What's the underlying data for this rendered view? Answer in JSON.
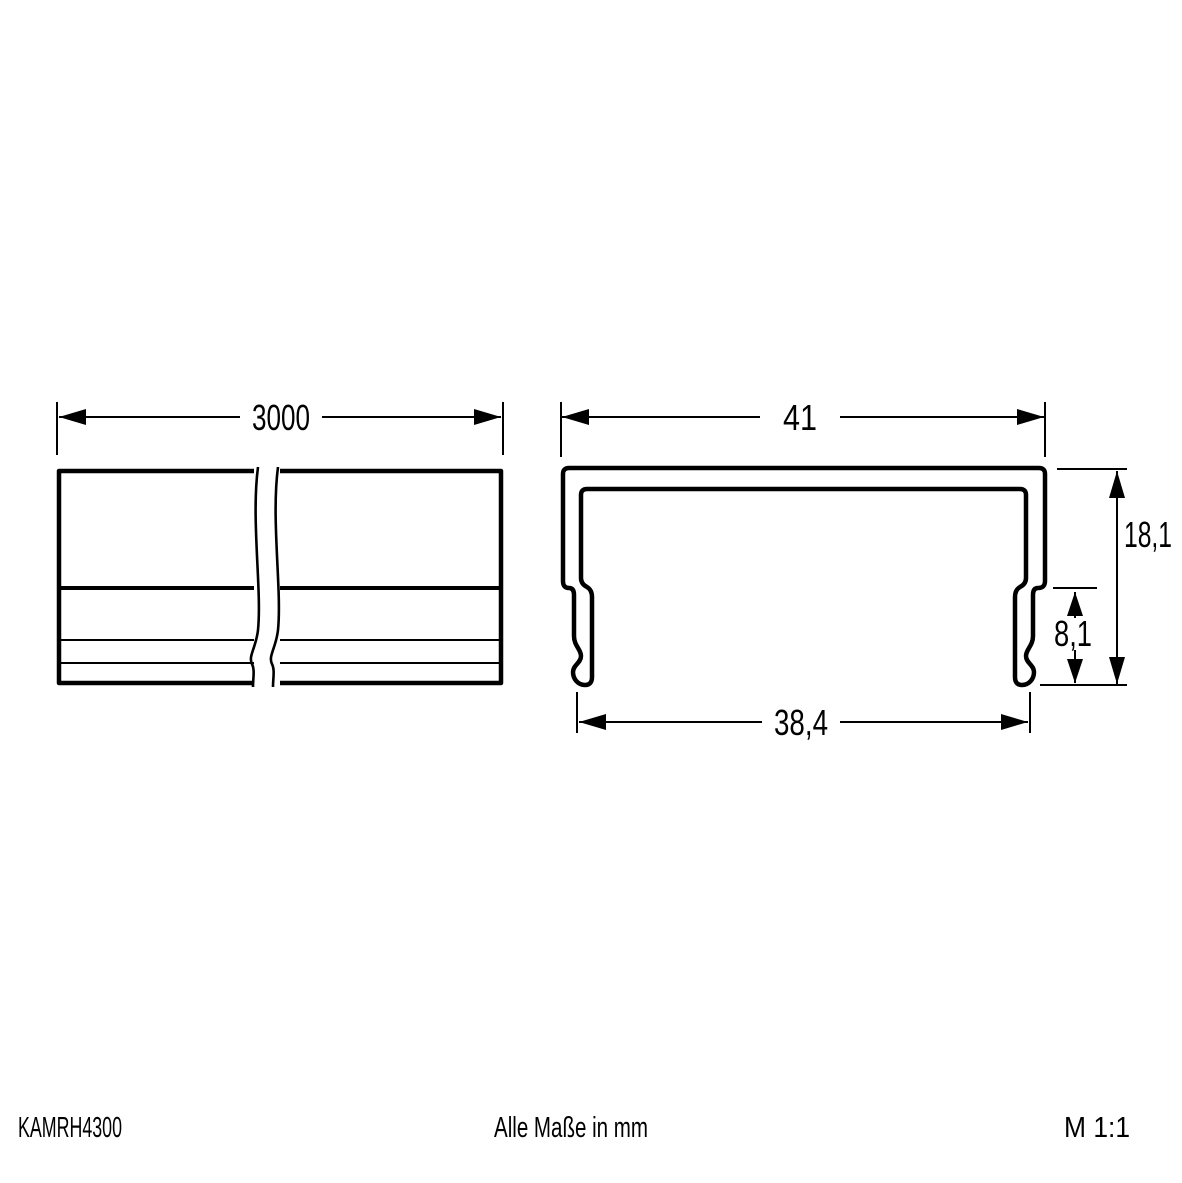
{
  "drawing": {
    "title": "KAMRH4300 profile dimension drawing",
    "colors": {
      "line": "#000000",
      "background": "#ffffff"
    },
    "side_view": {
      "length_label": "3000"
    },
    "cross_section": {
      "width_label": "41",
      "height_label": "18,1",
      "clip_height_label": "8,1",
      "base_width_label": "38,4"
    }
  },
  "footer": {
    "article_code": "KAMRH4300",
    "units_note": "Alle Maße in mm",
    "scale": "M 1:1"
  }
}
